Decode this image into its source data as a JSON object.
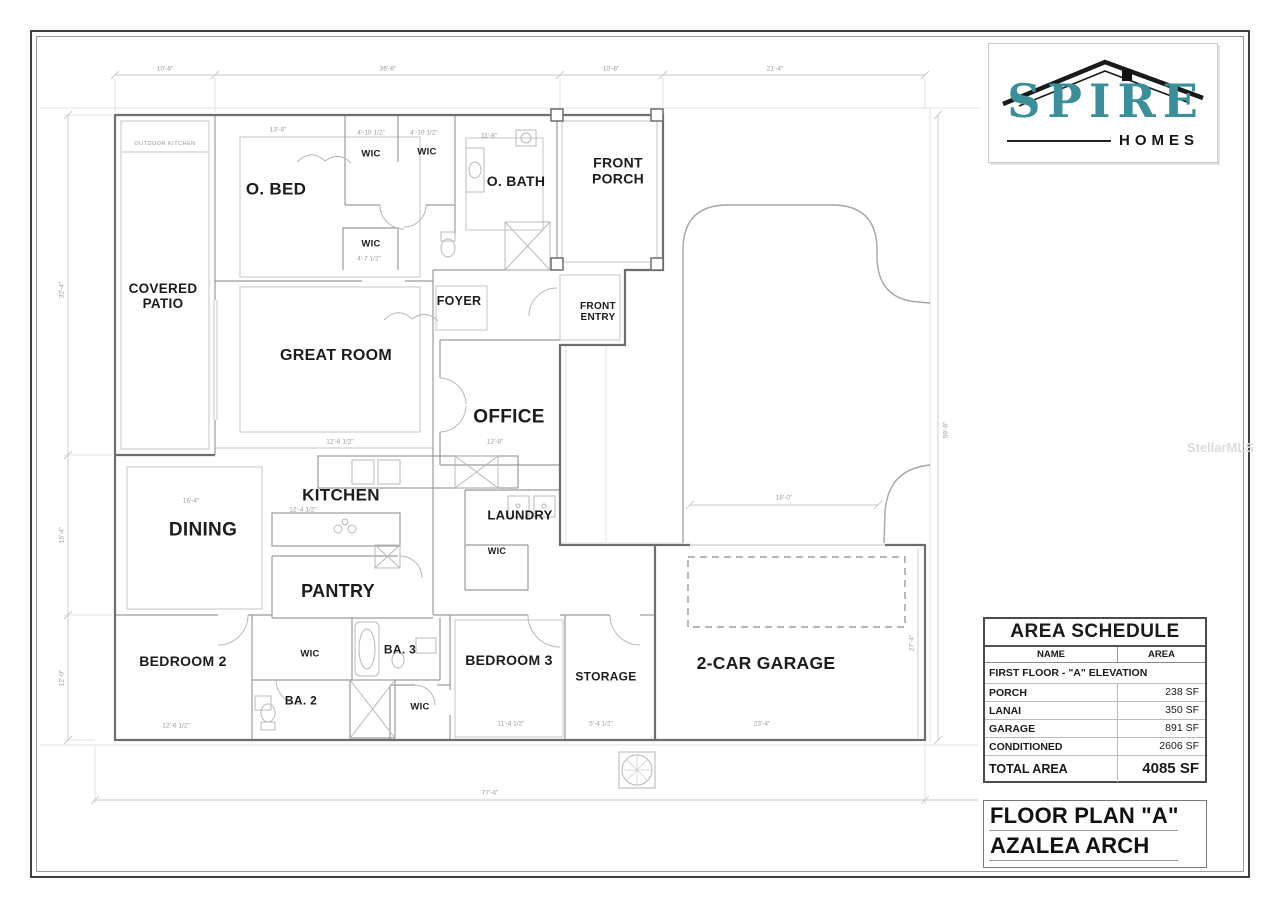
{
  "brand": {
    "name": "SPIRE",
    "sub": "HOMES"
  },
  "watermark": "StellarMLS",
  "plan": {
    "rooms": {
      "outdoor_kitchen": "OUTDOOR KITCHEN",
      "covered_patio": "COVERED\nPATIO",
      "o_bed": "O. BED",
      "wic": "WIC",
      "o_bath": "O. BATH",
      "front_porch": "FRONT\nPORCH",
      "foyer": "FOYER",
      "front_entry": "FRONT\nENTRY",
      "great_room": "GREAT ROOM",
      "office": "OFFICE",
      "kitchen": "KITCHEN",
      "laundry": "LAUNDRY",
      "dining": "DINING",
      "pantry": "PANTRY",
      "bedroom2": "BEDROOM 2",
      "ba2": "BA. 2",
      "ba3": "BA. 3",
      "bedroom3": "BEDROOM 3",
      "storage": "STORAGE",
      "garage": "2-CAR GARAGE"
    },
    "dims": {
      "top1": "10'-8\"",
      "top2": "36'-8\"",
      "top3": "10'-8\"",
      "top4": "21'-4\"",
      "left1": "32'-4\"",
      "left2": "15'-4\"",
      "left3": "12'-0\"",
      "right1": "59'-8\"",
      "right2": "27'-4\"",
      "bottom": "77'-4\"",
      "obed": "13'-8\"",
      "wic_a": "4'-10 1/2\"",
      "wic_b": "4'-10 1/2\"",
      "wic_c": "4'-7 1/2\"",
      "obath": "11'-8\"",
      "great": "12'-8 1/2\"",
      "kitchen": "12'-4 1/2\"",
      "dining": "16'-4\"",
      "office": "12'-8\"",
      "garage_door": "18'-0\"",
      "garage": "23'-4\"",
      "bed2": "12'-6 1/2\"",
      "bed3": "11'-4 1/2\"",
      "storage": "5'-4 1/2\""
    }
  },
  "area_schedule": {
    "title": "AREA SCHEDULE",
    "col_name": "NAME",
    "col_area": "AREA",
    "group": "FIRST FLOOR - \"A\" ELEVATION",
    "rows": [
      {
        "name": "PORCH",
        "area": "238 SF"
      },
      {
        "name": "LANAI",
        "area": "350 SF"
      },
      {
        "name": "GARAGE",
        "area": "891 SF"
      },
      {
        "name": "CONDITIONED",
        "area": "2606 SF"
      }
    ],
    "total_name": "TOTAL AREA",
    "total_area": "4085 SF"
  },
  "title_block": {
    "line1": "FLOOR PLAN \"A\"",
    "line2": "AZALEA ARCH"
  }
}
